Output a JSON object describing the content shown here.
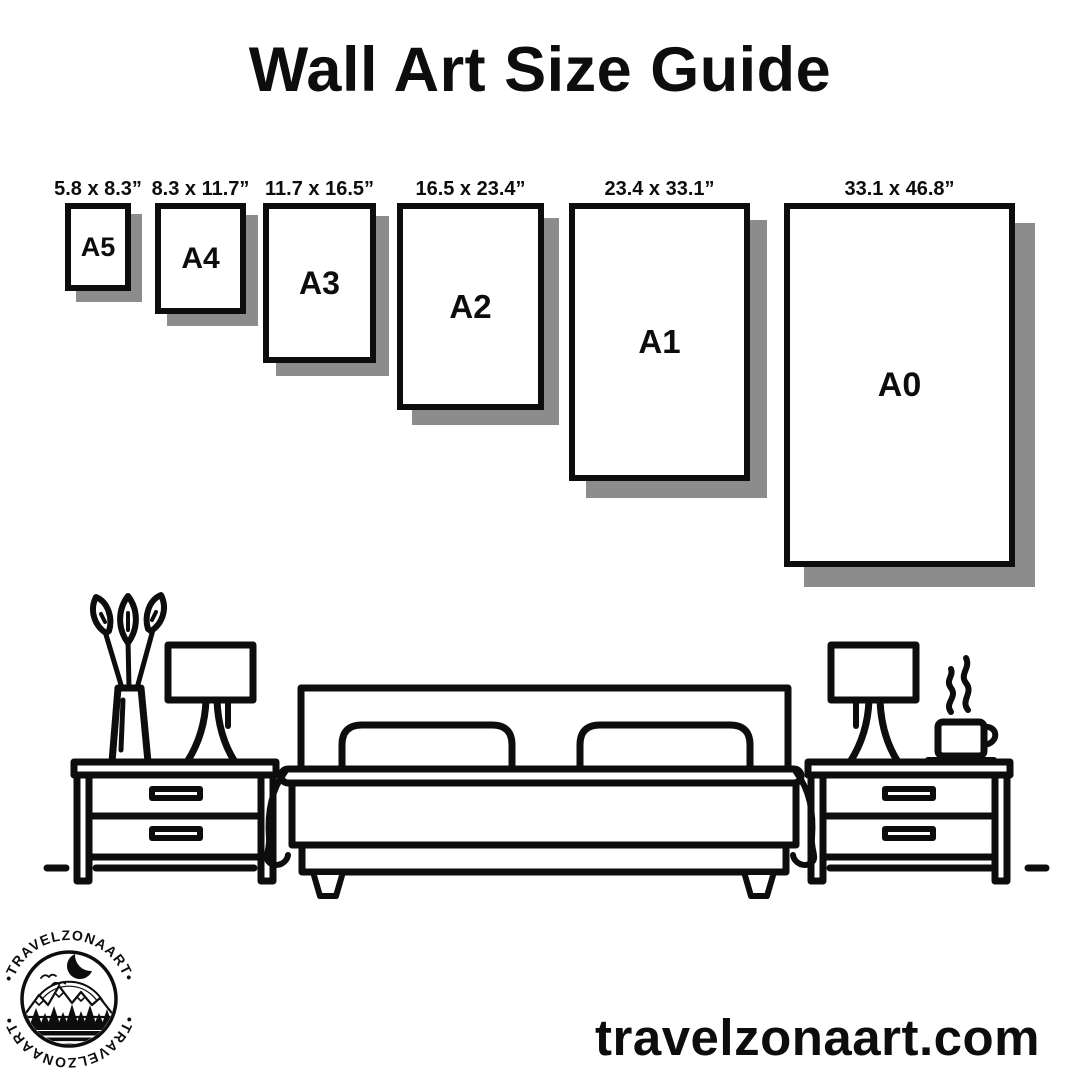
{
  "title": "Wall Art Size Guide",
  "frames": [
    {
      "size": "A5",
      "dimensions": "5.8 x 8.3”"
    },
    {
      "size": "A4",
      "dimensions": "8.3 x 11.7”"
    },
    {
      "size": "A3",
      "dimensions": "11.7 x 16.5”"
    },
    {
      "size": "A2",
      "dimensions": "16.5 x 23.4”"
    },
    {
      "size": "A1",
      "dimensions": "23.4 x 33.1”"
    },
    {
      "size": "A0",
      "dimensions": "33.1 x 46.8”"
    }
  ],
  "logo": {
    "arc_text_top": "•TRAVELZONAART•",
    "arc_text_bottom": "•TRAVELZONAART•"
  },
  "website": "travelzonaart.com",
  "colors": {
    "ink": "#0d0d0d",
    "shadow": "#8c8c8c",
    "background": "#ffffff"
  }
}
